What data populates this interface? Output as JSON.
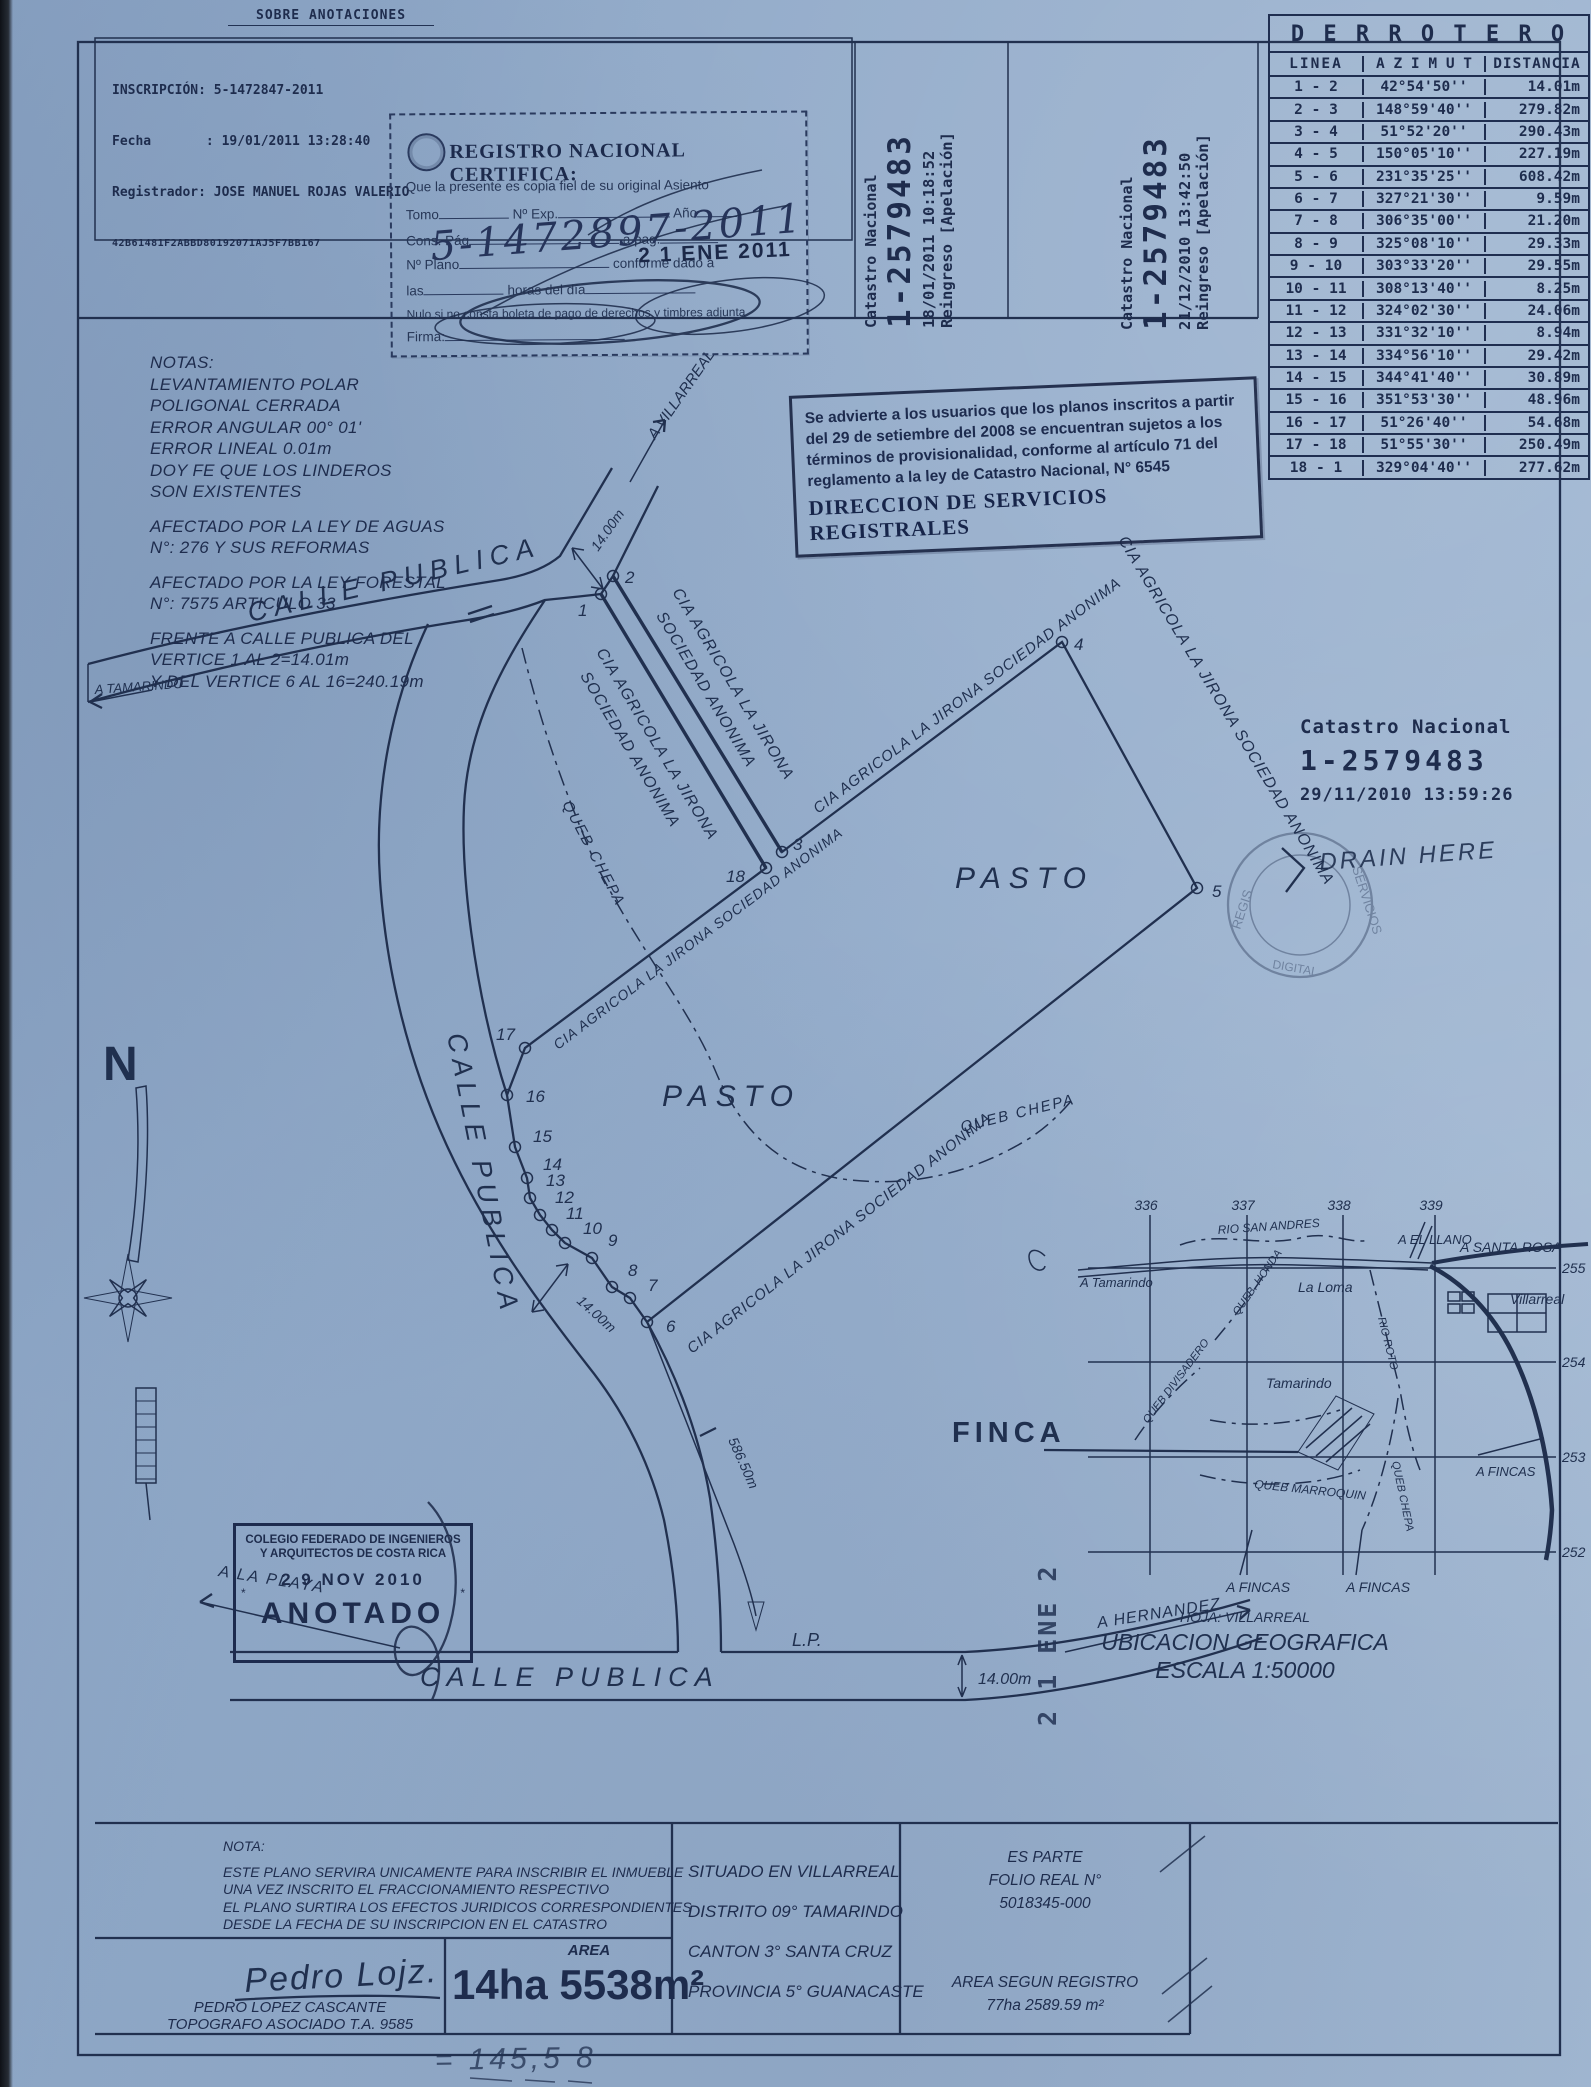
{
  "colors": {
    "paper": "#93abc9",
    "ink": "#1e2c4d",
    "stamp_ink": "#17233f"
  },
  "document": {
    "top_note": "SOBRE ANOTACIONES",
    "inscripcion": {
      "l1": "INSCRIPCIÓN: 5-1472847-2011",
      "l2": "Fecha       : 19/01/2011 13:28:40",
      "l3": "Registrador: JOSE MANUEL ROJAS VALERIO",
      "l4": "42B61481F2ABBD80192071AJ5F7BB167"
    },
    "registro": {
      "title": "REGISTRO NACIONAL CERTIFICA:",
      "certify_line": "Que la presente es copia fiel de su original Asiento",
      "f_tomo": "Tomo",
      "f_exp": "Nº Exp.",
      "f_ano": "Año",
      "f_cons": "Cons. Pág",
      "f_apag": "a pag.",
      "f_plano": "Nº Plano",
      "f_conforme": "conforme dado a",
      "f_las": "las",
      "f_horas": "horas del día",
      "f_nulo": "Nulo si no consta boleta de pago de derechos y timbres adjunta",
      "f_firma": "Firma:",
      "handwritten_no": "5-1472897-2011",
      "date_stamp": "2 1 ENE 2011"
    },
    "reingreso_left": {
      "l1": "Catastro Nacional",
      "l2": "1-2579483",
      "l3": "18/01/2011 10:18:52",
      "l4": "Reingreso [Apelación]"
    },
    "reingreso_right": {
      "l1": "Catastro Nacional",
      "l2": "1-2579483",
      "l3": "21/12/2010 13:42:50",
      "l4": "Reingreso [Apelación]"
    }
  },
  "derrotero": {
    "title": "D E R R O T E R O",
    "col_linea": "LINEA",
    "col_azimut": "A Z I M U T",
    "col_distancia": "DISTANCIA",
    "rows": [
      {
        "linea": "1 - 2",
        "azimut": "42°54'50''",
        "distancia": "14.01m"
      },
      {
        "linea": "2 - 3",
        "azimut": "148°59'40''",
        "distancia": "279.82m"
      },
      {
        "linea": "3 - 4",
        "azimut": "51°52'20''",
        "distancia": "290.43m"
      },
      {
        "linea": "4 - 5",
        "azimut": "150°05'10''",
        "distancia": "227.19m"
      },
      {
        "linea": "5 - 6",
        "azimut": "231°35'25''",
        "distancia": "608.42m"
      },
      {
        "linea": "6 - 7",
        "azimut": "327°21'30''",
        "distancia": "9.59m"
      },
      {
        "linea": "7 - 8",
        "azimut": "306°35'00''",
        "distancia": "21.20m"
      },
      {
        "linea": "8 - 9",
        "azimut": "325°08'10''",
        "distancia": "29.33m"
      },
      {
        "linea": "9 - 10",
        "azimut": "303°33'20''",
        "distancia": "29.55m"
      },
      {
        "linea": "10 - 11",
        "azimut": "308°13'40''",
        "distancia": "8.25m"
      },
      {
        "linea": "11 - 12",
        "azimut": "324°02'30''",
        "distancia": "24.06m"
      },
      {
        "linea": "12 - 13",
        "azimut": "331°32'10''",
        "distancia": "8.94m"
      },
      {
        "linea": "13 - 14",
        "azimut": "334°56'10''",
        "distancia": "29.42m"
      },
      {
        "linea": "14 - 15",
        "azimut": "344°41'40''",
        "distancia": "30.89m"
      },
      {
        "linea": "15 - 16",
        "azimut": "351°53'30''",
        "distancia": "48.96m"
      },
      {
        "linea": "16 - 17",
        "azimut": "51°26'40''",
        "distancia": "54.68m"
      },
      {
        "linea": "17 - 18",
        "azimut": "51°55'30''",
        "distancia": "250.49m"
      },
      {
        "linea": "18 - 1",
        "azimut": "329°04'40''",
        "distancia": "277.62m"
      }
    ]
  },
  "notas": {
    "b1": [
      "NOTAS:",
      "LEVANTAMIENTO POLAR",
      "POLIGONAL CERRADA",
      "ERROR ANGULAR 00° 01'",
      "ERROR LINEAL 0.01m",
      "DOY FE QUE LOS LINDEROS",
      "SON EXISTENTES"
    ],
    "b2": [
      "AFECTADO POR LA LEY DE AGUAS",
      "N°: 276 Y SUS REFORMAS"
    ],
    "b3": [
      "AFECTADO POR LA LEY FORESTAL",
      "N°: 7575 ARTICULO 33"
    ],
    "b4": [
      "FRENTE A CALLE PUBLICA DEL",
      "VERTICE 1 AL 2=14.01m",
      "Y DEL VERTICE 6 AL 16=240.19m"
    ]
  },
  "aviso": {
    "l1": "Se advierte a los usuarios que los planos inscritos a partir",
    "l2": "del 29 de setiembre del 2008 se encuentran sujetos a los",
    "l3": "términos de provisionalidad, conforme al artículo 71 del",
    "l4": "reglamento a la ley de Catastro Nacional, N° 6545",
    "firma": "DIRECCION DE SERVICIOS REGISTRALES"
  },
  "sello": {
    "l1": "Catastro Nacional",
    "l2": "1-2579483",
    "l3": "29/11/2010 13:59:26",
    "handwritten": "DRAIN HERE"
  },
  "seal": {
    "t1": "SERVICIOS",
    "t2": "REGIS",
    "t3": "DIGITAL"
  },
  "map": {
    "calle_publica": "CALLE PUBLICA",
    "a_tamarindo": "A TAMARINDO",
    "a_villarreal": "A VILLARREAL",
    "a_la_playa": "A LA PLAYA",
    "a_hernandez": "A HERNANDEZ",
    "lp": "L.P.",
    "pasto": "PASTO",
    "queb_chepa": "QUEB CHEPA",
    "cia_l1": "CIA AGRICOLA LA JIRONA",
    "cia_l2": "SOCIEDAD ANONIMA",
    "cia_full": "CIA AGRICOLA LA JIRONA SOCIEDAD ANONIMA",
    "dim_14": "14.00m",
    "dim_586": "586.50m",
    "north": "N",
    "finca": "FINCA",
    "ene_stamp": "2 1 ENE 2",
    "vertices": [
      "1",
      "2",
      "3",
      "4",
      "5",
      "6",
      "7",
      "8",
      "9",
      "10",
      "11",
      "12",
      "13",
      "14",
      "15",
      "16",
      "17",
      "18"
    ]
  },
  "loc": {
    "grid_top": [
      "336",
      "337",
      "338",
      "339"
    ],
    "grid_right": [
      "255",
      "254",
      "253",
      "252"
    ],
    "rio_san_andres": "RIO SAN ANDRES",
    "a_el_llano": "A EL LLANO",
    "a_santa_rosa": "A SANTA ROSA",
    "a_tamarindo": "A Tamarindo",
    "queb_honda": "QUEB. HONDA",
    "la_loma": "La Loma",
    "villarreal": "Villarreal",
    "rio_roto": "RIO ROTO",
    "queb_divisadero": "QUEB DIVISADERO",
    "tamarindo": "Tamarindo",
    "queb_marroquin": "QUEB MARROQUIN",
    "queb_chepa": "QUEB CHEPA",
    "a_fincas": "A FINCAS",
    "hoja": "HOJA: VILLARREAL",
    "ubicacion": "UBICACION GEOGRAFICA",
    "escala": "ESCALA 1:50000"
  },
  "colegio": {
    "l1": "COLEGIO FEDERADO DE INGENIEROS",
    "l2": "Y ARQUITECTOS DE COSTA RICA",
    "date": "2 9 NOV 2010",
    "star": "*",
    "anotado": "ANOTADO"
  },
  "footer": {
    "nota_title": "NOTA:",
    "nota": [
      "ESTE PLANO SERVIRA UNICAMENTE PARA INSCRIBIR EL INMUEBLE",
      "UNA VEZ INSCRITO EL FRACCIONAMIENTO RESPECTIVO",
      "EL PLANO SURTIRA LOS EFECTOS JURIDICOS CORRESPONDIENTES",
      "DESDE LA FECHA DE SU INSCRIPCION EN EL CATASTRO"
    ],
    "sig": "Pedro Lojz.",
    "name": "PEDRO LOPEZ CASCANTE",
    "title": "TOPOGRAFO ASOCIADO T.A. 9585",
    "area_label": "AREA",
    "area_value": "14ha 5538m²",
    "situado": [
      "SITUADO EN VILLARREAL",
      "DISTRITO 09° TAMARINDO",
      "CANTON 3° SANTA CRUZ",
      "PROVINCIA 5° GUANACASTE"
    ],
    "es_parte": [
      "ES PARTE",
      "FOLIO REAL N°",
      "5018345-000"
    ],
    "area_reg": [
      "AREA SEGUN REGISTRO",
      "77ha 2589.59 m²"
    ],
    "hand_bottom": "= 145,5 8"
  }
}
